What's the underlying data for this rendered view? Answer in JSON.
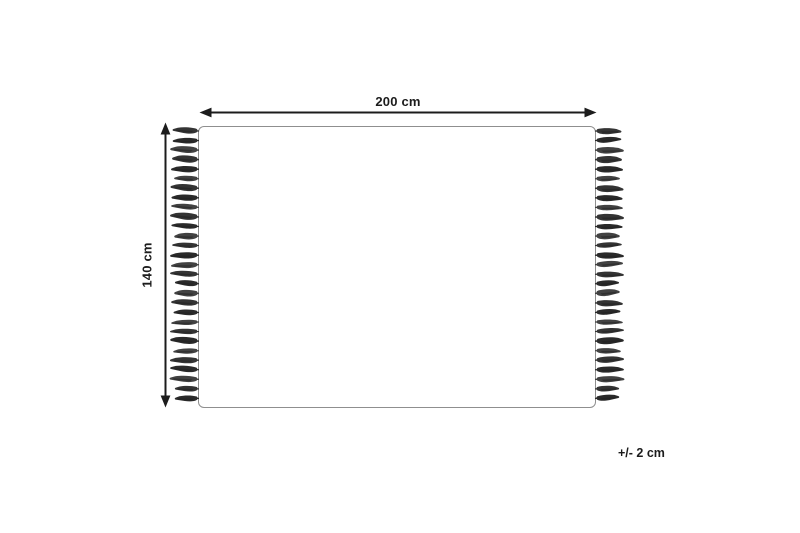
{
  "diagram": {
    "type": "rug-dimension-diagram",
    "labels": {
      "width": "200 cm",
      "height": "140 cm",
      "tolerance": "+/- 2 cm"
    },
    "colors": {
      "ink": "#1c1c1c",
      "rug_border": "#8f8f8f",
      "rug_fill": "#ffffff",
      "tassel_shades": [
        "#343434",
        "#2a2a2a",
        "#424242"
      ],
      "tassel_streak": "#1e1e1e"
    },
    "tassels": {
      "per_side": 29,
      "spacing_px": 9.55,
      "length_px": 27
    }
  }
}
